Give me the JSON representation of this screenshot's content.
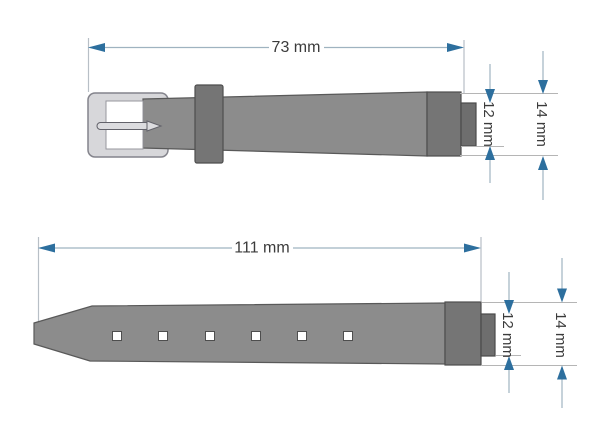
{
  "diagram": {
    "subject": "watch-strap-dimensions",
    "top_piece": {
      "description": "buckle-side strap",
      "length_label": "73 mm",
      "lug_width_label": "12 mm",
      "strap_width_label": "14 mm"
    },
    "bottom_piece": {
      "description": "long-side strap with holes",
      "length_label": "111 mm",
      "lug_width_label": "12 mm",
      "strap_width_label": "14 mm",
      "hole_count": 6
    },
    "colors": {
      "arrow_blue": "#2d6f9e",
      "dim_line": "#9fb3c0",
      "ext_line": "#b8bfc6",
      "ref_line": "#b5b5b5",
      "strap_gray": "#8c8c8c",
      "dark_gray": "#757575",
      "buckle_silver": "#d7d7da",
      "text": "#3b3b3b",
      "background": "#ffffff"
    }
  }
}
